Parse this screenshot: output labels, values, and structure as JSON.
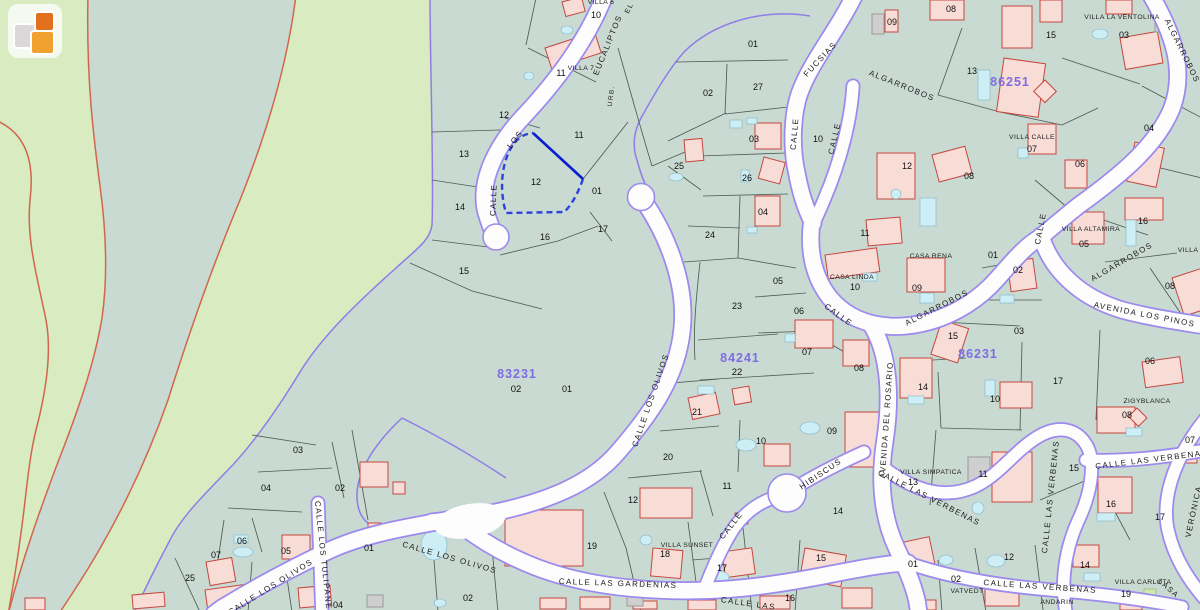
{
  "map": {
    "logo": {
      "name": "catastro-logo"
    },
    "colors": {
      "rural_green": "#d8ebc1",
      "urban_sage": "#c9dad2",
      "road_white": "#fdfdfd",
      "road_edge_violet": "#9c8aee",
      "rural_boundary_red": "#d2654f",
      "building_pink": "#f8dcd6",
      "building_red": "#c5473f",
      "pool_blue": "#cdeef5",
      "block_label_purple": "#7e6ce4",
      "selection_blue": "#0a1ecf"
    },
    "block_labels": [
      {
        "text": "83231",
        "x": 517,
        "y": 378,
        "sub": "02",
        "subx": 516,
        "suby": 392
      },
      {
        "text": "84241",
        "x": 740,
        "y": 362,
        "sub": "22",
        "subx": 737,
        "suby": 375
      },
      {
        "text": "86231",
        "x": 978,
        "y": 358
      },
      {
        "text": "86251",
        "x": 1010,
        "y": 86
      }
    ],
    "street_labels": [
      [
        "EUCALIPTOS",
        610,
        46,
        -68
      ],
      [
        "LOS",
        517,
        141,
        -52
      ],
      [
        "CALLE",
        496,
        200,
        -88
      ],
      [
        "URB.",
        613,
        96,
        -83,
        6.5
      ],
      [
        "EL",
        631,
        9,
        -62,
        7
      ],
      [
        "CALLE",
        797,
        134,
        -85
      ],
      [
        "FUCSIAS",
        822,
        61,
        -47
      ],
      [
        "CALLE",
        837,
        139,
        -77
      ],
      [
        "ALGARROBOS",
        901,
        88,
        22
      ],
      [
        "ALGARROBOS",
        1180,
        52,
        64
      ],
      [
        "CALLE",
        837,
        317,
        36
      ],
      [
        "ALGARROBOS",
        938,
        310,
        -27
      ],
      [
        "CALLE",
        1043,
        229,
        -79
      ],
      [
        "ALGARROBOS",
        1123,
        264,
        -30
      ],
      [
        "AVENIDA LOS PINOS",
        1144,
        317,
        11
      ],
      [
        "CALLE LOS OLIVOS",
        653,
        401,
        -71
      ],
      [
        "AVENIDA DEL ROSARIO",
        889,
        420,
        -86
      ],
      [
        "HIBISCUS",
        822,
        476,
        -34
      ],
      [
        "CALLE",
        733,
        527,
        -52
      ],
      [
        "CALLE LAS VERBENAS",
        928,
        500,
        27
      ],
      [
        "CALLE LAS VERBENAS",
        1053,
        497,
        -84
      ],
      [
        "CALLE LAS VERBENAS",
        1152,
        462,
        -7
      ],
      [
        "CALLE LAS VERBENAS",
        1040,
        589,
        4
      ],
      [
        "VERÓNICA",
        1196,
        512,
        -78
      ],
      [
        "LASA",
        1167,
        590,
        42,
        7.5
      ],
      [
        "CALLE LOS TULIPANES",
        321,
        559,
        84
      ],
      [
        "CALLE LOS OLIVOS",
        272,
        589,
        -32
      ],
      [
        "CALLE LOS OLIVOS",
        449,
        560,
        16
      ],
      [
        "CALLE LAS GARDENIAS",
        618,
        586,
        2
      ],
      [
        "CALLE LAS",
        748,
        606,
        8
      ]
    ],
    "house_labels": [
      [
        "VILLA 6",
        601,
        4
      ],
      [
        "VILLA 7",
        581,
        70
      ],
      [
        "VILLA LA VENTOLINA",
        1122,
        19
      ],
      [
        "VILLA CALLE",
        1032,
        139
      ],
      [
        "VILLA ALTAMIRA",
        1091,
        231
      ],
      [
        "VILLA",
        1188,
        252
      ],
      [
        "CASA LINDA",
        852,
        279
      ],
      [
        "CASA RENA",
        931,
        258
      ],
      [
        "VILLA SIMPATICA",
        931,
        474
      ],
      [
        "VILLA SUNSET",
        687,
        547
      ],
      [
        "ZIGYBLANCA",
        1147,
        403
      ],
      [
        "VATVEDT",
        967,
        593
      ],
      [
        "VILLA CARLOTA",
        1143,
        584
      ],
      [
        "ANDARIN",
        1057,
        604
      ]
    ],
    "parcel_labels": [
      [
        "10",
        596,
        18
      ],
      [
        "11",
        561,
        76
      ],
      [
        "12",
        504,
        118
      ],
      [
        "11",
        579,
        138
      ],
      [
        "13",
        464,
        157
      ],
      [
        "12",
        536,
        185
      ],
      [
        "01",
        597,
        194
      ],
      [
        "14",
        460,
        210
      ],
      [
        "17",
        603,
        232
      ],
      [
        "16",
        545,
        240
      ],
      [
        "15",
        464,
        274
      ],
      [
        "25",
        679,
        169
      ],
      [
        "26",
        747,
        181
      ],
      [
        "03",
        754,
        142
      ],
      [
        "02",
        708,
        96
      ],
      [
        "27",
        758,
        90
      ],
      [
        "01",
        753,
        47
      ],
      [
        "09",
        892,
        25
      ],
      [
        "10",
        818,
        142
      ],
      [
        "24",
        710,
        238
      ],
      [
        "04",
        763,
        215
      ],
      [
        "05",
        778,
        284
      ],
      [
        "23",
        737,
        309
      ],
      [
        "06",
        799,
        314
      ],
      [
        "07",
        807,
        355
      ],
      [
        "08",
        859,
        371
      ],
      [
        "21",
        697,
        415
      ],
      [
        "20",
        668,
        460
      ],
      [
        "10",
        761,
        444
      ],
      [
        "09",
        832,
        434
      ],
      [
        "11",
        865,
        236
      ],
      [
        "12",
        907,
        169
      ],
      [
        "08",
        969,
        179
      ],
      [
        "10",
        855,
        290
      ],
      [
        "09",
        917,
        291
      ],
      [
        "08",
        951,
        12
      ],
      [
        "13",
        972,
        74
      ],
      [
        "15",
        1051,
        38
      ],
      [
        "03",
        1124,
        38
      ],
      [
        "04",
        1149,
        131
      ],
      [
        "07",
        1032,
        152
      ],
      [
        "06",
        1080,
        167
      ],
      [
        "16",
        1143,
        224
      ],
      [
        "05",
        1084,
        247
      ],
      [
        "08",
        1170,
        289
      ],
      [
        "01",
        993,
        258
      ],
      [
        "02",
        1018,
        273
      ],
      [
        "03",
        1019,
        334
      ],
      [
        "15",
        953,
        339
      ],
      [
        "14",
        923,
        390
      ],
      [
        "10",
        995,
        402
      ],
      [
        "17",
        1058,
        384
      ],
      [
        "06",
        1150,
        364
      ],
      [
        "11",
        983,
        477
      ],
      [
        "13",
        913,
        485
      ],
      [
        "08",
        1127,
        418
      ],
      [
        "07",
        1190,
        443
      ],
      [
        "15",
        1074,
        471
      ],
      [
        "16",
        1111,
        507
      ],
      [
        "17",
        1160,
        520
      ],
      [
        "14",
        1085,
        568
      ],
      [
        "14",
        838,
        514
      ],
      [
        "12",
        1009,
        560
      ],
      [
        "19",
        1126,
        597
      ],
      [
        "02",
        956,
        582
      ],
      [
        "01",
        913,
        567
      ],
      [
        "15",
        821,
        561
      ],
      [
        "16",
        790,
        601
      ],
      [
        "17",
        722,
        571
      ],
      [
        "18",
        665,
        557
      ],
      [
        "11",
        727,
        489
      ],
      [
        "12",
        633,
        503
      ],
      [
        "19",
        592,
        549
      ],
      [
        "01",
        369,
        551
      ],
      [
        "01",
        567,
        392
      ],
      [
        "02",
        468,
        601
      ],
      [
        "03",
        298,
        453
      ],
      [
        "04",
        266,
        491
      ],
      [
        "02",
        340,
        491
      ],
      [
        "06",
        242,
        544
      ],
      [
        "05",
        286,
        554
      ],
      [
        "07",
        216,
        558
      ],
      [
        "25",
        190,
        581
      ],
      [
        "04",
        338,
        608
      ]
    ],
    "features": {
      "buildings": [
        [
          562,
          2,
          20,
          15,
          -15
        ],
        [
          545,
          48,
          52,
          22,
          -18
        ],
        [
          755,
          123,
          26,
          26,
          0
        ],
        [
          764,
          157,
          22,
          22,
          15
        ],
        [
          684,
          140,
          18,
          22,
          -5
        ],
        [
          885,
          10,
          13,
          22,
          0
        ],
        [
          930,
          0,
          34,
          20,
          0
        ],
        [
          1002,
          6,
          30,
          42,
          0
        ],
        [
          1004,
          58,
          42,
          54,
          8
        ],
        [
          1045,
          80,
          16,
          16,
          45
        ],
        [
          1040,
          0,
          22,
          22,
          0
        ],
        [
          1106,
          0,
          26,
          14,
          0
        ],
        [
          1120,
          38,
          38,
          32,
          -10
        ],
        [
          1135,
          142,
          30,
          40,
          12
        ],
        [
          1125,
          198,
          38,
          22,
          0
        ],
        [
          1072,
          212,
          32,
          32,
          0
        ],
        [
          1028,
          124,
          28,
          30,
          0
        ],
        [
          1065,
          160,
          22,
          28,
          0
        ],
        [
          1007,
          262,
          26,
          30,
          -8
        ],
        [
          942,
          320,
          28,
          36,
          18
        ],
        [
          1172,
          278,
          30,
          40,
          -18
        ],
        [
          1142,
          362,
          38,
          26,
          -8
        ],
        [
          1000,
          382,
          32,
          26,
          0
        ],
        [
          900,
          358,
          32,
          40,
          0
        ],
        [
          992,
          452,
          40,
          50,
          0
        ],
        [
          1097,
          407,
          38,
          26,
          0
        ],
        [
          1137,
          408,
          14,
          12,
          45
        ],
        [
          1182,
          447,
          15,
          16,
          0
        ],
        [
          1098,
          477,
          34,
          36,
          0
        ],
        [
          1073,
          545,
          26,
          22,
          0
        ],
        [
          1120,
          598,
          22,
          12,
          0
        ],
        [
          825,
          255,
          52,
          24,
          -8
        ],
        [
          866,
          220,
          34,
          26,
          -5
        ],
        [
          877,
          153,
          38,
          46,
          0
        ],
        [
          932,
          155,
          34,
          28,
          -15
        ],
        [
          907,
          258,
          38,
          34,
          0
        ],
        [
          843,
          340,
          26,
          26,
          0
        ],
        [
          795,
          320,
          38,
          28,
          0
        ],
        [
          732,
          389,
          17,
          16,
          -10
        ],
        [
          688,
          398,
          28,
          22,
          -12
        ],
        [
          764,
          444,
          26,
          22,
          0
        ],
        [
          845,
          412,
          36,
          55,
          0
        ],
        [
          755,
          196,
          25,
          30,
          0
        ],
        [
          505,
          510,
          78,
          56,
          0
        ],
        [
          640,
          488,
          52,
          30,
          0
        ],
        [
          735,
          513,
          13,
          11,
          0
        ],
        [
          653,
          548,
          30,
          28,
          5
        ],
        [
          722,
          552,
          30,
          26,
          -8
        ],
        [
          805,
          548,
          42,
          32,
          10
        ],
        [
          890,
          545,
          40,
          28,
          -12
        ],
        [
          985,
          588,
          34,
          18,
          0
        ],
        [
          842,
          588,
          30,
          20,
          0
        ],
        [
          760,
          596,
          30,
          13,
          0
        ],
        [
          540,
          598,
          26,
          11,
          0
        ],
        [
          580,
          597,
          30,
          12,
          0
        ],
        [
          688,
          600,
          28,
          10,
          0
        ],
        [
          633,
          601,
          24,
          8,
          0
        ],
        [
          360,
          462,
          28,
          25,
          0
        ],
        [
          393,
          482,
          12,
          12,
          0
        ],
        [
          282,
          535,
          28,
          24,
          0
        ],
        [
          206,
          562,
          26,
          24,
          -10
        ],
        [
          298,
          588,
          32,
          20,
          -5
        ],
        [
          368,
          523,
          13,
          16,
          0
        ],
        [
          205,
          590,
          42,
          18,
          -8
        ],
        [
          132,
          595,
          32,
          14,
          -5
        ],
        [
          25,
          598,
          20,
          12,
          0
        ],
        [
          916,
          600,
          20,
          10,
          0
        ]
      ],
      "gray_buildings": [
        [
          872,
          14,
          12,
          20,
          0
        ],
        [
          367,
          595,
          16,
          12,
          0
        ],
        [
          627,
          594,
          16,
          12,
          0
        ],
        [
          968,
          457,
          22,
          28,
          0
        ],
        [
          1155,
          14,
          12,
          18,
          0
        ]
      ],
      "pools": [
        [
          567,
          30,
          6,
          4,
          "e"
        ],
        [
          529,
          76,
          5,
          4,
          "e"
        ],
        [
          676,
          177,
          7,
          4,
          "e"
        ],
        [
          736,
          124,
          6,
          4,
          "r"
        ],
        [
          752,
          121,
          5,
          3,
          "r"
        ],
        [
          745,
          176,
          4,
          6,
          "r"
        ],
        [
          752,
          230,
          5,
          3,
          "r"
        ],
        [
          790,
          338,
          5,
          4,
          "r"
        ],
        [
          706,
          390,
          8,
          4,
          "r"
        ],
        [
          746,
          445,
          10,
          6,
          "e"
        ],
        [
          810,
          428,
          10,
          6,
          "e"
        ],
        [
          870,
          277,
          7,
          4,
          "r"
        ],
        [
          928,
          212,
          8,
          14,
          "r"
        ],
        [
          896,
          194,
          5,
          5,
          "e"
        ],
        [
          927,
          298,
          7,
          5,
          "r"
        ],
        [
          984,
          85,
          6,
          15,
          "r"
        ],
        [
          1023,
          153,
          5,
          5,
          "r"
        ],
        [
          1100,
          34,
          8,
          5,
          "e"
        ],
        [
          1131,
          233,
          5,
          13,
          "r"
        ],
        [
          1007,
          299,
          7,
          4,
          "r"
        ],
        [
          916,
          400,
          8,
          4,
          "r"
        ],
        [
          990,
          388,
          5,
          8,
          "r"
        ],
        [
          1134,
          432,
          8,
          4,
          "r"
        ],
        [
          1106,
          517,
          9,
          4,
          "r"
        ],
        [
          1092,
          577,
          8,
          4,
          "r"
        ],
        [
          996,
          561,
          9,
          6,
          "e"
        ],
        [
          978,
          508,
          6,
          6,
          "e"
        ],
        [
          946,
          560,
          7,
          5,
          "e"
        ],
        [
          717,
          577,
          12,
          6,
          "e"
        ],
        [
          646,
          540,
          6,
          5,
          "e"
        ],
        [
          434,
          545,
          13,
          15,
          "e"
        ],
        [
          243,
          552,
          10,
          5,
          "e"
        ],
        [
          318,
          567,
          5,
          4,
          "e"
        ],
        [
          241,
          539,
          7,
          4,
          "r"
        ],
        [
          440,
          603,
          6,
          4,
          "e"
        ]
      ],
      "green_pools": [
        [
          1150,
          595,
          6,
          6
        ]
      ]
    }
  }
}
